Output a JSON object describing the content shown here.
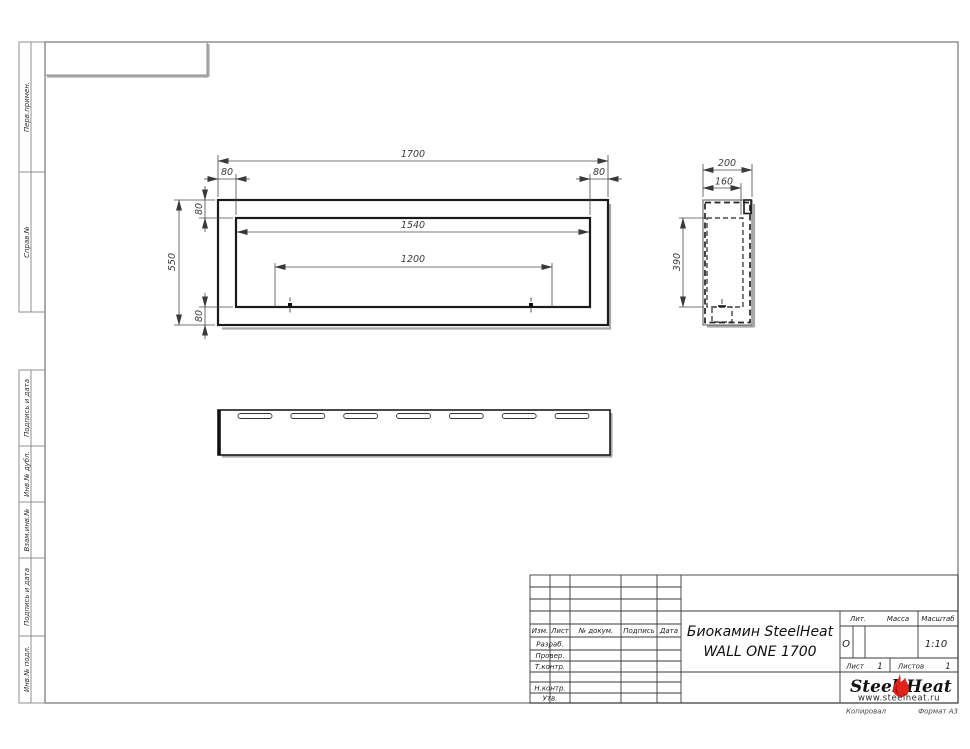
{
  "colors": {
    "frame_line": "#8f8f8f",
    "drawing_line": "#1b1b1b",
    "dim_line": "#4a4a4a",
    "flame_red": "#e2231a",
    "flame_dark": "#a91209"
  },
  "sidebar": {
    "top": [
      {
        "label": "Перв.примен."
      },
      {
        "label": "Справ.№"
      }
    ],
    "bottom": [
      {
        "label": "Подпись и дата"
      },
      {
        "label": "Инв.№ дубл."
      },
      {
        "label": "Взам.инв.№"
      },
      {
        "label": "Подпись и дата"
      },
      {
        "label": "Инв.№ подл."
      }
    ]
  },
  "dimensions": {
    "front": {
      "total_width": "1700",
      "margin_left": "80",
      "margin_right": "80",
      "inner_width": "1540",
      "slot_span": "1200",
      "total_height": "550",
      "margin_top": "80",
      "margin_bottom": "80"
    },
    "side": {
      "depth": "200",
      "inner_depth": "160",
      "inner_height": "390"
    }
  },
  "title_block": {
    "cols": {
      "izm": "Изм.",
      "list": "Лист",
      "doc": "№ докум.",
      "sign": "Подпись",
      "date": "Дата"
    },
    "rows": {
      "razrab": "Разраб.",
      "prover": "Провер.",
      "tkontr": "Т.контр.",
      "nkontr": "Н.контр.",
      "utv": "Утв."
    },
    "title_line1": "Биокамин SteelHeat",
    "title_line2": "WALL ONE 1700",
    "lit_label": "Лит.",
    "lit_value": "О",
    "mass_label": "Масса",
    "scale_label": "Масштаб",
    "scale_value": "1:10",
    "sheet_label": "Лист",
    "sheet_value": "1",
    "sheets_label": "Листов",
    "sheets_value": "1",
    "logo": {
      "part1": "Steel",
      "part2": "Heat",
      "url": "www.steelheat.ru"
    }
  },
  "footer": {
    "copied": "Копировал",
    "format": "Формат А3"
  }
}
